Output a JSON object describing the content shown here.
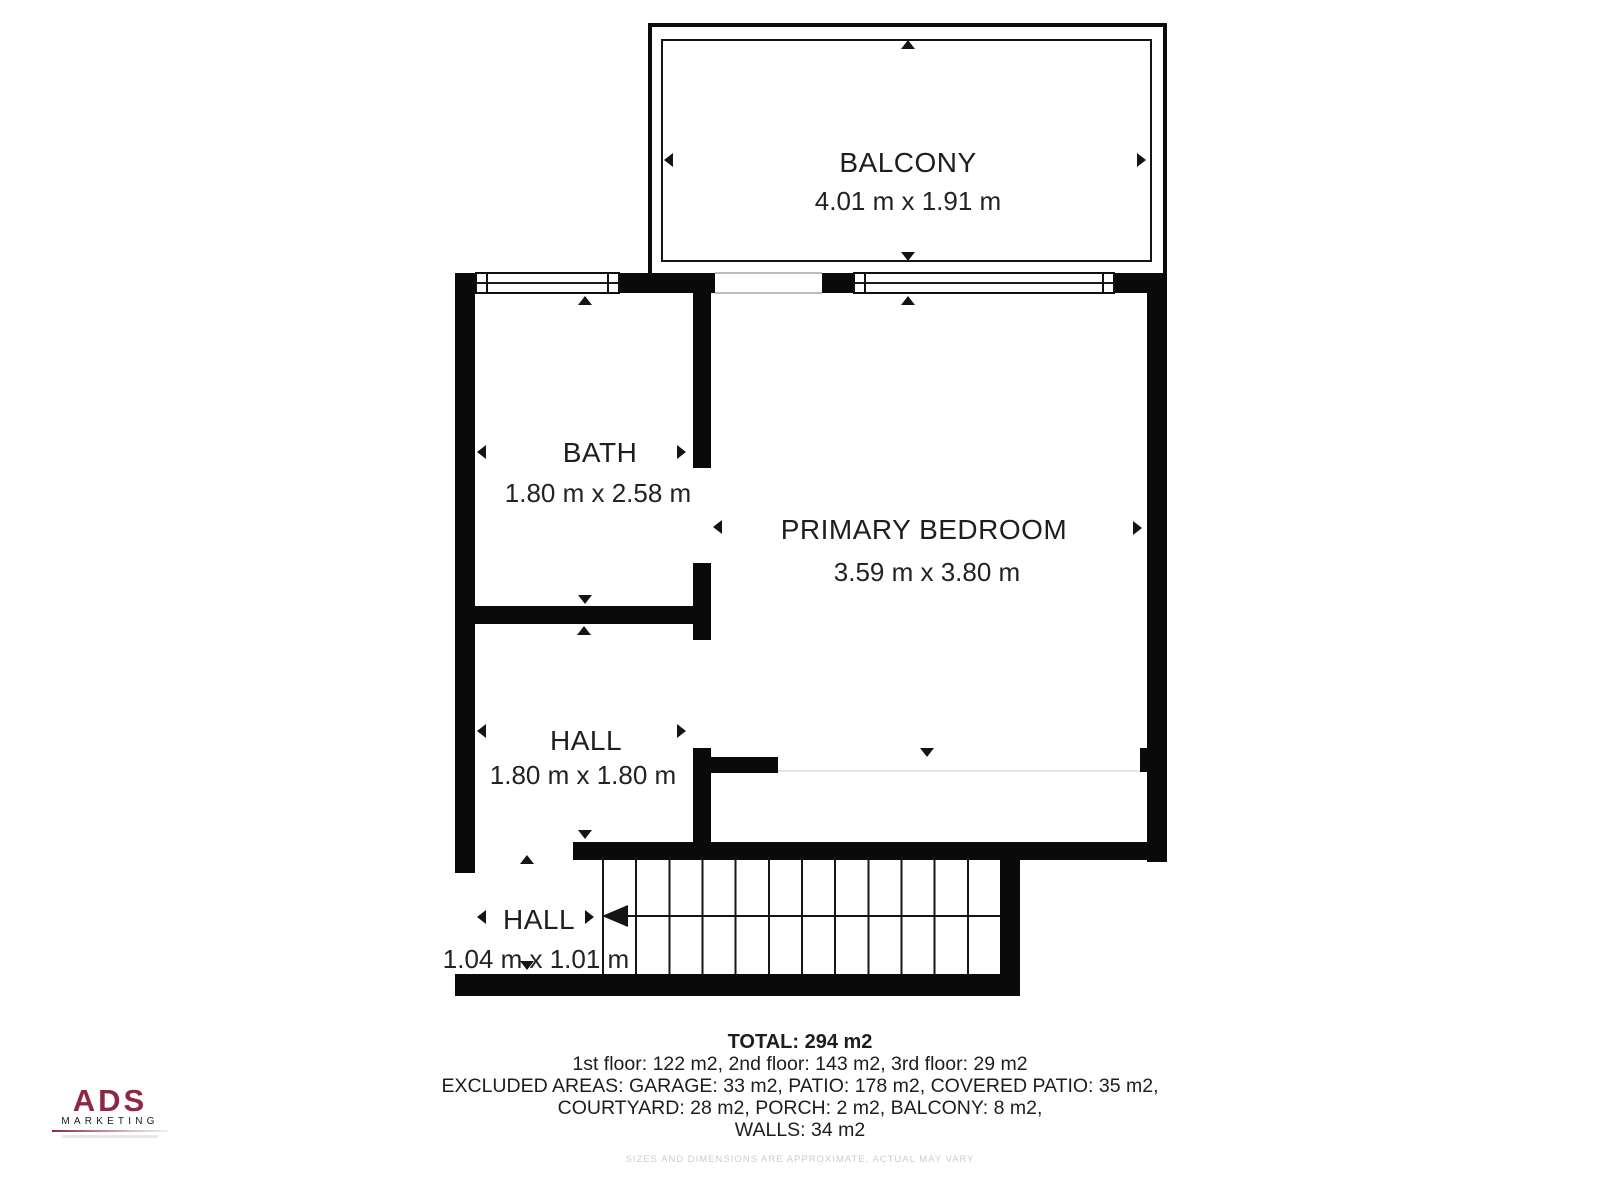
{
  "rooms": [
    {
      "id": "balcony",
      "label": "BALCONY",
      "dimensions": "4.01 m x 1.91 m"
    },
    {
      "id": "bath",
      "label": "BATH",
      "dimensions": "1.80 m x 2.58 m"
    },
    {
      "id": "primary_bedroom",
      "label": "PRIMARY BEDROOM",
      "dimensions": "3.59 m x 3.80 m"
    },
    {
      "id": "hall_upper",
      "label": "HALL",
      "dimensions": "1.80 m x 1.80 m"
    },
    {
      "id": "hall_lower",
      "label": "HALL",
      "dimensions": "1.04 m x 1.01 m"
    }
  ],
  "summary": {
    "total": "TOTAL: 294 m2",
    "floors": "1st floor: 122 m2, 2nd floor: 143 m2, 3rd floor: 29 m2",
    "excluded_line1": "EXCLUDED AREAS: GARAGE: 33 m2, PATIO: 178 m2, COVERED PATIO: 35 m2,",
    "excluded_line2": "COURTYARD: 28 m2, PORCH: 2 m2, BALCONY: 8 m2,",
    "walls": "WALLS: 34 m2"
  },
  "branding": {
    "logo_name": "ADS",
    "logo_subtitle": "MARKETING"
  },
  "disclaimer": "SIZES AND DIMENSIONS ARE APPROXIMATE, ACTUAL MAY VARY",
  "stairs": {
    "tread_count": 12,
    "direction": "left"
  },
  "colors": {
    "wall": "#0a0a0a",
    "text": "#1c1c1c",
    "logo_accent": "#8e2743",
    "faint_text": "#cccccc"
  }
}
